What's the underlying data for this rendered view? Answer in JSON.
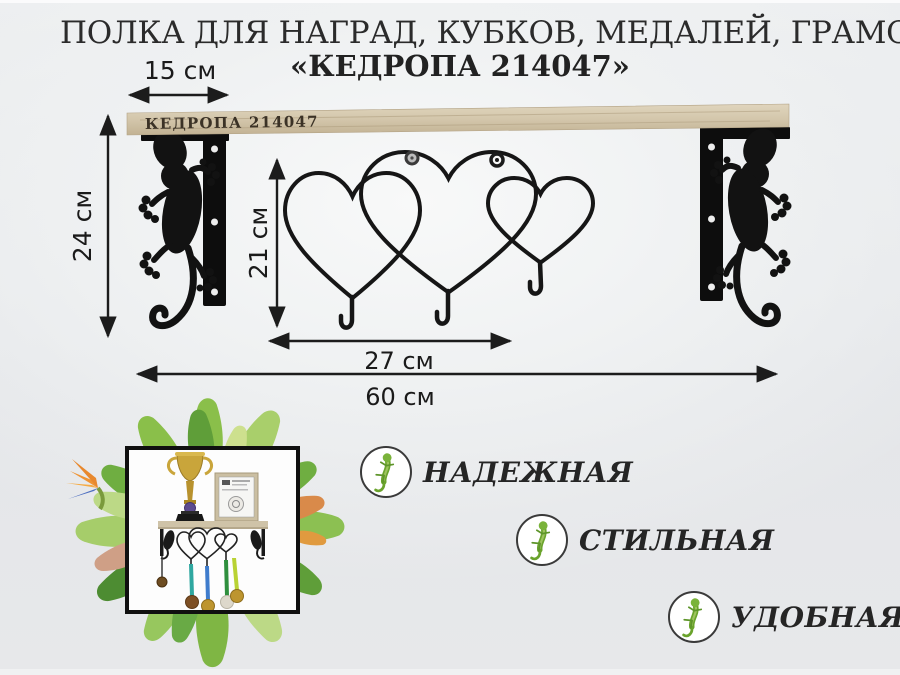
{
  "header": {
    "title_line1": "ПОЛКА ДЛЯ НАГРАД, КУБКОВ, МЕДАЛЕЙ, ГРАМОТ",
    "title_line2": "«КЕДРОПА 214047»"
  },
  "board": {
    "brand_label": "КЕДРОПА 214047"
  },
  "dimensions": {
    "shelf_depth": "15 см",
    "bracket_height": "24 см",
    "hanger_height": "21 см",
    "hanger_width": "27 см",
    "shelf_length": "60 см"
  },
  "features": [
    {
      "label": "НАДЕЖНАЯ",
      "icon": "gecko-icon"
    },
    {
      "label": "СТИЛЬНАЯ",
      "icon": "gecko-icon"
    },
    {
      "label": "УДОБНАЯ",
      "icon": "gecko-icon"
    }
  ],
  "icons": {
    "bracket_left": "gecko-bracket-icon",
    "bracket_right": "gecko-bracket-icon",
    "hanger": "triple-heart-hooks-icon",
    "photo_decor": "tropical-leaf-wreath"
  },
  "colors": {
    "background": "#e6e8ea",
    "wood": "#d3c6ab",
    "metal": "#101010",
    "gecko_green": "#6fae34",
    "text": "#222222",
    "ribbon_teal": "#2fa7a0",
    "ribbon_blue": "#3f7ccc",
    "ribbon_green": "#2f8f3e",
    "ribbon_yellow_green": "#b9d234",
    "medal_gold": "#bd952f",
    "medal_bronze": "#7d4f24",
    "medal_silver": "#ddd8cb"
  }
}
